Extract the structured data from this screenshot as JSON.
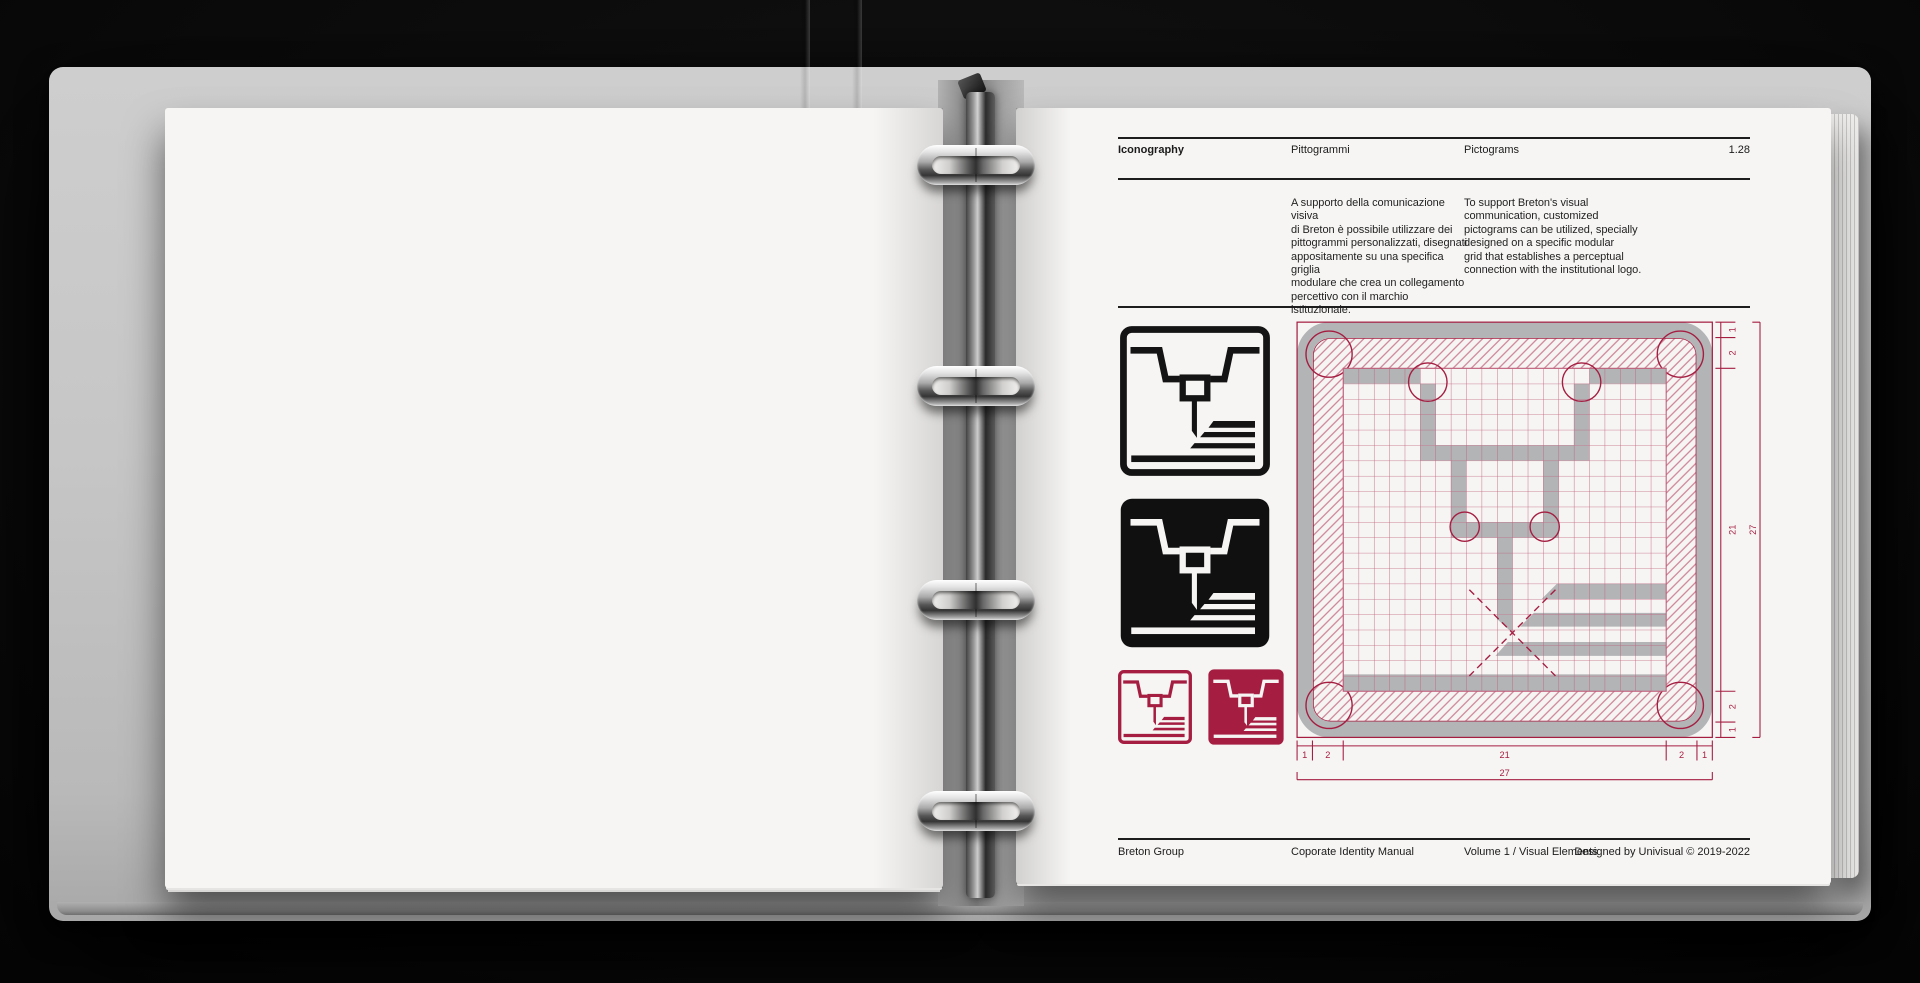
{
  "header": {
    "title": "Iconography",
    "subtitle_it": "Pittogrammi",
    "subtitle_en": "Pictograms",
    "page_number": "1.28"
  },
  "intro": {
    "paragraph_it": "A supporto della comunicazione visiva\ndi Breton è possibile utilizzare dei\npittogrammi personalizzati, disegnati\nappositamente su una specifica griglia\nmodulare che crea un collegamento\npercettivo con il marchio istituzionale.",
    "paragraph_en": "To support Breton's visual\ncommunication, customized\npictograms can be utilized, specially\ndesigned on a specific modular\ngrid that establishes a perceptual\nconnection with the institutional logo."
  },
  "pictogram": {
    "icon_name": "cnc-machine-pictogram",
    "variants": [
      "outline-black",
      "solid-black",
      "outline-red",
      "solid-red"
    ],
    "colors": {
      "black": "#141414",
      "red": "#A51E42",
      "white": "#f6f5f3"
    }
  },
  "diagram": {
    "name": "pictogram-construction-grid",
    "dims": [
      "1",
      "2",
      "21",
      "2",
      "1"
    ],
    "total": "27",
    "colors": {
      "accent": "#A51E42",
      "grid_line": "#C05F7B",
      "shape_gray": "#B2B4B6"
    }
  },
  "footer": {
    "company": "Breton Group",
    "manual": "Coporate Identity Manual",
    "volume": "Volume 1 / Visual Elements",
    "credit": "Designed by Univisual © 2019-2022"
  }
}
